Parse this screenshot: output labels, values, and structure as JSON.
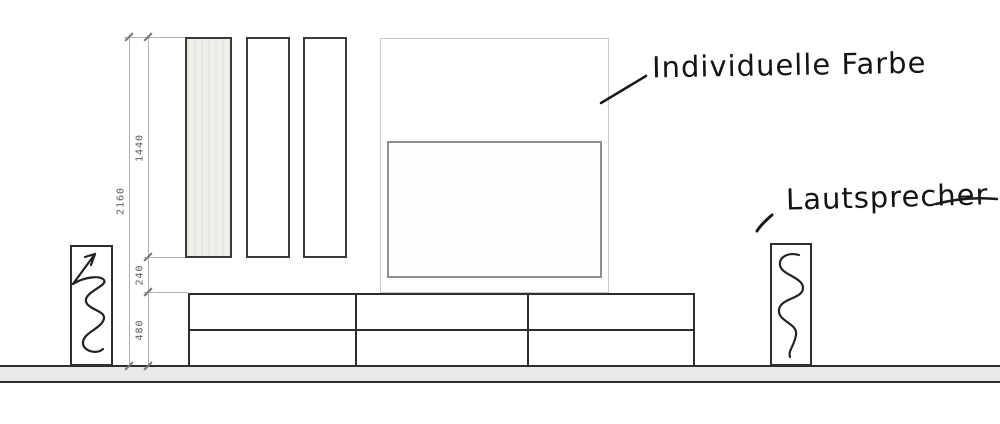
{
  "drawing_title": "wall-unit elevation sketch",
  "annotations": {
    "individuelle_farbe": "Individuelle Farbe",
    "lautsprecher": "Lautsprecher"
  },
  "dimensions": {
    "total_height": "2160",
    "panel_height": "1440",
    "gap_height": "240",
    "lowboard_height": "480"
  },
  "structure": {
    "wall_panel_count": 3,
    "lowboard_columns": 3,
    "lowboard_rows": 2,
    "speaker_count": 2
  },
  "colors": {
    "furniture_line": "#2e2e2e",
    "panel_fill": "#eef0ea",
    "tv_border": "#8f8f8f",
    "backpanel_border": "#c9c9c9",
    "dimension_line": "#b3b3b3",
    "dimension_text": "#5e5e5e",
    "floor_fill": "#e9e9ec",
    "ink": "#141414"
  }
}
